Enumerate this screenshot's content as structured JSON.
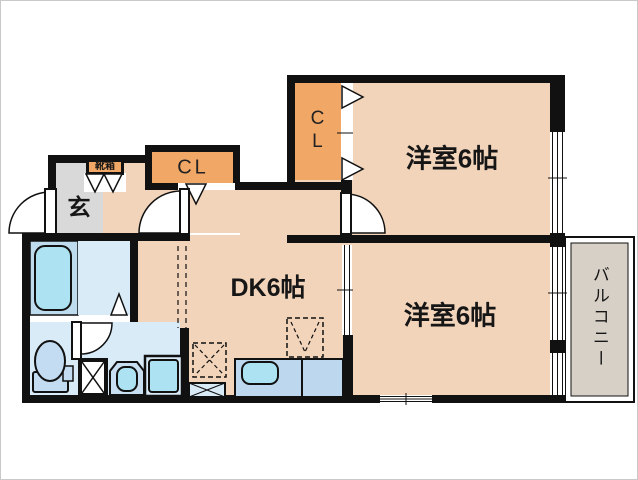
{
  "plan": {
    "type": "japanese-apartment-floor-plan",
    "rooms": {
      "entrance": {
        "label": "玄"
      },
      "shoe_box": {
        "label": "靴箱"
      },
      "hall_closet": {
        "label": "CL"
      },
      "bedroom_closet": {
        "label": "CL"
      },
      "bedroom1": {
        "label": "洋室6帖"
      },
      "bedroom2": {
        "label": "洋室6帖"
      },
      "dining_kitchen": {
        "label": "DK6帖"
      },
      "balcony": {
        "label": "バルコニー"
      }
    },
    "colors": {
      "wall": "#111111",
      "room_floor": "#F2D4BA",
      "closet_fill": "#F1A766",
      "entrance_floor": "#D9D9D9",
      "balcony_floor": "#D7D0C6",
      "wet_area_floor": "#DAEBF8",
      "bath_floor": "#BFDCEE",
      "counter_fill": "#BDD8EE",
      "fixture_cyan": "#ACE2F1",
      "fixture_blue": "#C3DCF2"
    }
  }
}
